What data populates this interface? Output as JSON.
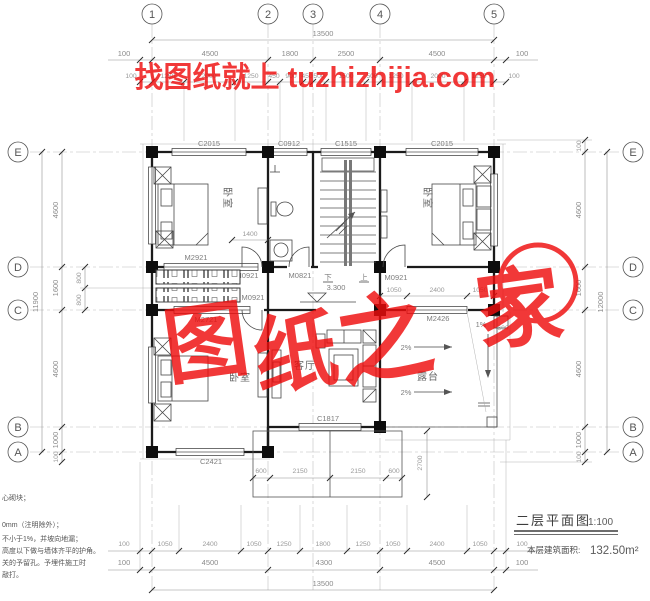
{
  "watermark": {
    "top": "找图纸就上 tuzhizhijia.com",
    "chars": [
      "图",
      "纸",
      "之",
      "家"
    ],
    "color": "#e81111"
  },
  "grid": {
    "cols": [
      "1",
      "2",
      "3",
      "4",
      "5"
    ],
    "rows": [
      "E",
      "D",
      "C",
      "B",
      "A"
    ]
  },
  "dims": {
    "t_total": "13500",
    "t1": [
      "100",
      "4500",
      "1800",
      "2500",
      "4500",
      "100"
    ],
    "t2": [
      "100",
      "1250",
      "2000",
      "1250",
      "450",
      "900",
      "450",
      "500",
      "1500",
      "500",
      "1250",
      "2000",
      "1250",
      "100"
    ],
    "b1": [
      "100",
      "1050",
      "2400",
      "1050",
      "1250",
      "1800",
      "1250",
      "1050",
      "2400",
      "1050",
      "100"
    ],
    "b2": [
      "100",
      "4500",
      "4300",
      "4500",
      "100"
    ],
    "b_total": "13500",
    "l1": [
      "4600",
      "1600",
      "4600",
      "1000",
      "100"
    ],
    "l800": [
      "800",
      "800"
    ],
    "l_total": "11900",
    "r1": [
      "100",
      "4600",
      "1600",
      "4600",
      "1000",
      "100"
    ],
    "r_total": "12000",
    "bath": "1400",
    "corridor": [
      "1050",
      "2400",
      "1050"
    ],
    "balcony": [
      "600",
      "2150",
      "2150",
      "600"
    ],
    "balcony_depth": "2700",
    "terrace_600": "600"
  },
  "windows": {
    "top": [
      "C2015",
      "C0912",
      "C1515",
      "C2015"
    ],
    "bottom_left": "C2421",
    "bottom_center": "C1817"
  },
  "doors": {
    "m2921": "M2921",
    "m0921": "M0921",
    "m0821": "M0821",
    "m2721": "M2721",
    "m2426": "M2426"
  },
  "rooms": {
    "bedroom": "卧室",
    "living": "客厅",
    "terrace": "露台"
  },
  "stairs": {
    "up": "上",
    "down": "下",
    "level": "3.300"
  },
  "slopes": {
    "two": "2%",
    "one": "1%"
  },
  "title": {
    "name": "二层平面图",
    "scale": "1:100",
    "area_label": "本层建筑面积:",
    "area": "132.50m²"
  },
  "notes": [
    "心砌块；",
    "0mm（注明除外）；",
    "不小于1%，并坡向地漏；",
    "高度以下做与墙体齐平的护角。",
    "关的予留孔。予埋件施工时",
    "敲打。"
  ]
}
